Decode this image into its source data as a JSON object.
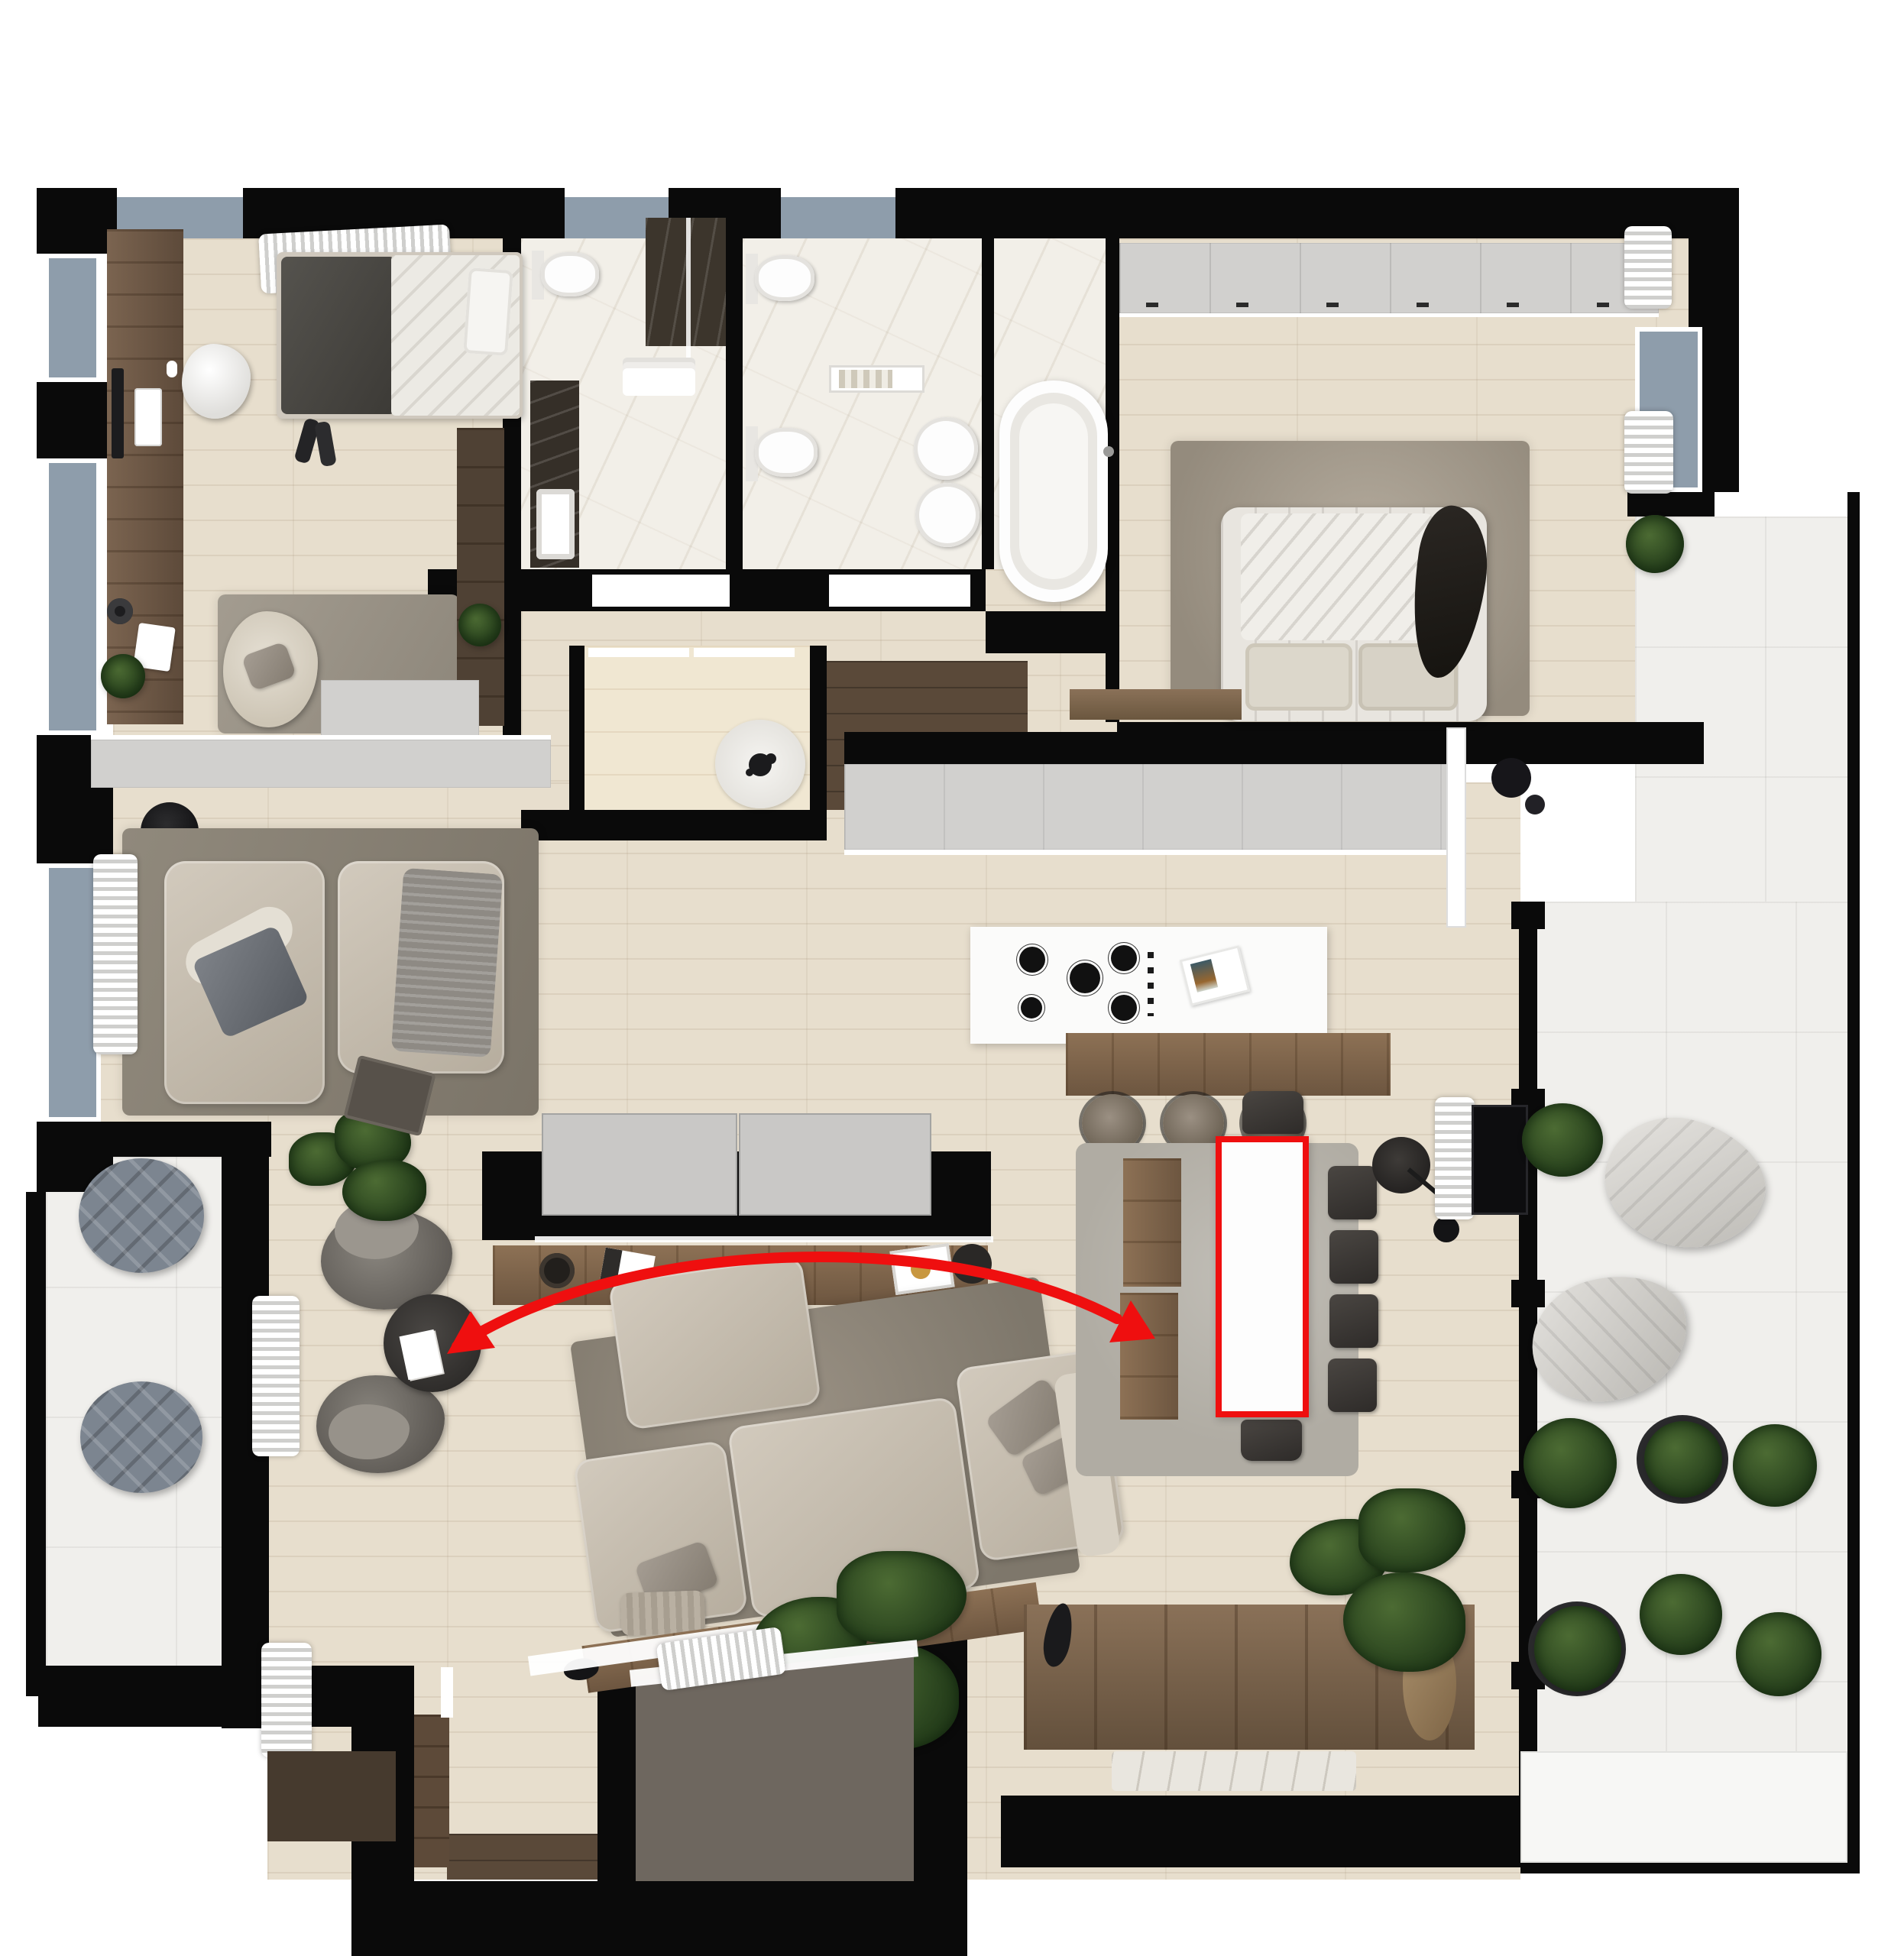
{
  "meta": {
    "type": "apartment-floor-plan-render",
    "view": "top-down-3d",
    "background": "#ffffff"
  },
  "colors": {
    "wall": "#0a0a0a",
    "floor_wood": "#e7decd",
    "floor_wood_light": "#f0e7d2",
    "floor_marble": "#f2efe8",
    "floor_stone": "#f0efec",
    "cabinet_gray": "#d1d0ce",
    "tv_panel_gray": "#c9c8c6",
    "dark_wood": "#5a4939",
    "rustic_wood": "#82694f",
    "rug_brown_gray": "#8b8275",
    "rug_light_gray": "#b0aca3",
    "sofa_beige": "#c7bfb1",
    "pouf_blue_gray": "#7c8590",
    "chair_dark": "#3a3734",
    "armchair_gray": "#73706b",
    "plant_green": "#2d4a24",
    "window_glass": "#8e9dab",
    "annotation_red": "#ef0f0f",
    "entry_pad": "#6e675f"
  },
  "annotations": {
    "highlight": {
      "target": "dining-table",
      "shape": "rectangle",
      "color": "#ef0f0f"
    },
    "arrow": {
      "style": "curved-arc",
      "double_headed": true,
      "color": "#ef0f0f",
      "from": "dining-table-area",
      "to": "lounge-coffee-table-area"
    }
  },
  "rooms": [
    {
      "id": "bedroom-top-left",
      "furniture": [
        "single-bed",
        "dark-blanket",
        "pillow",
        "desk",
        "monitor",
        "keyboard",
        "desk-chair",
        "area-rug",
        "lounge-armchair",
        "sideboard",
        "wardrobe",
        "potted-plant",
        "window-curtain"
      ]
    },
    {
      "id": "bathroom-1",
      "furniture": [
        "toilet",
        "vanity-sink",
        "dark-marble-counter",
        "shower",
        "towels"
      ]
    },
    {
      "id": "bathroom-2",
      "furniture": [
        "toilet",
        "wall-hung-toilet",
        "bidet",
        "bidet",
        "shelf-with-towels",
        "freestanding-bathtub"
      ]
    },
    {
      "id": "master-bedroom",
      "furniture": [
        "wardrobe-run",
        "double-bed",
        "pillows",
        "draped-garment",
        "shaggy-rug",
        "foot-bench",
        "black-stool",
        "curtains",
        "balcony-door"
      ]
    },
    {
      "id": "hallway-closets",
      "furniture": [
        "walk-in-closet",
        "dark-wood-hall",
        "round-rug",
        "decor-object"
      ]
    },
    {
      "id": "kitchen",
      "furniture": [
        "cabinet-run",
        "island-with-hob",
        "gas-burners",
        "knobs",
        "magazine",
        "wood-counter-extension",
        "bar-stool",
        "bar-stool",
        "bar-stool",
        "tall-cabinet"
      ]
    },
    {
      "id": "living-room",
      "furniture": [
        "tv-partition-wall",
        "sliding-gray-panels",
        "media-console",
        "decor-items",
        "sectional-sofa",
        "ottoman",
        "shaggy-rug",
        "wood-back-console",
        "armchair",
        "armchair",
        "coffee-table",
        "floor-lamp",
        "sheepskin",
        "house-plant",
        "house-plant"
      ]
    },
    {
      "id": "dining-area",
      "furniture": [
        "dining-table",
        "dining-chair",
        "dining-chair",
        "dining-chair",
        "dining-chair",
        "dining-chair",
        "dining-chair",
        "wood-bench",
        "shaggy-rug",
        "side-table",
        "floor-lamp",
        "curtain",
        "wall-tv-panel",
        "rustic-sideboard",
        "marble-tray"
      ]
    },
    {
      "id": "terrace-left",
      "furniture": [
        "round-pouf",
        "round-pouf"
      ]
    },
    {
      "id": "terrace-right",
      "furniture": [
        "bean-bag",
        "bean-bag",
        "topiary-bush",
        "topiary-bush",
        "topiary-bush",
        "topiary-bush",
        "topiary-bush",
        "topiary-bush",
        "topiary-bush",
        "planter-band"
      ]
    },
    {
      "id": "entrance",
      "furniture": [
        "entry-pad",
        "threshold",
        "built-in-wardrobe",
        "corridor"
      ]
    }
  ]
}
